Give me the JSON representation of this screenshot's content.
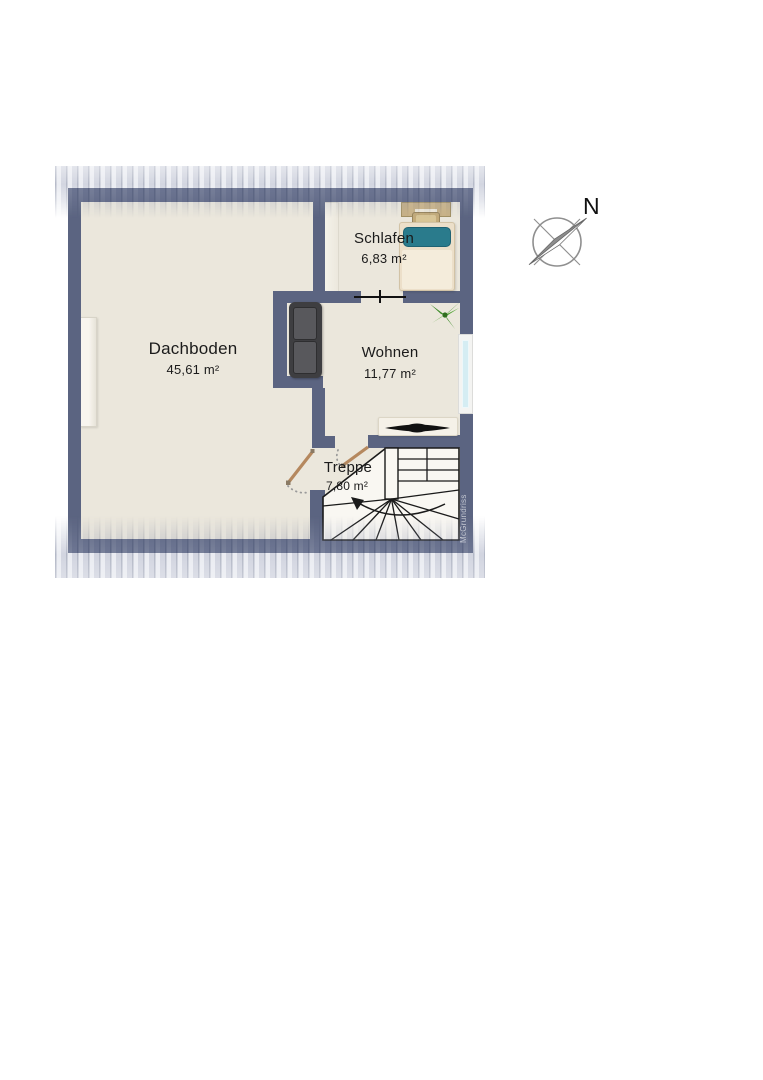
{
  "floorplan": {
    "rooms": [
      {
        "name": "Dachboden",
        "area": "45,61 m²"
      },
      {
        "name": "Schlafen",
        "area": "6,83 m²"
      },
      {
        "name": "Wohnen",
        "area": "11,77 m²"
      },
      {
        "name": "Treppe",
        "area": "7,80 m²"
      }
    ],
    "compass": {
      "north_label": "N"
    },
    "watermark": "McGrundriss",
    "objects": [
      "bed",
      "pillow",
      "desk",
      "chair",
      "sofa",
      "plant",
      "tv-lowboard",
      "staircase",
      "door-leaf",
      "window",
      "wardrobe"
    ],
    "colors": {
      "wall": "#5b6481",
      "floor": "#ebe7dc",
      "stair_floor": "#f9f7f2",
      "window_glass": "#d5edf3",
      "bed_pillow": "#2a7b8c",
      "plant_green": "#3e8c2a",
      "door_leaf": "#b5885e",
      "sofa": "#3e3e41"
    }
  }
}
